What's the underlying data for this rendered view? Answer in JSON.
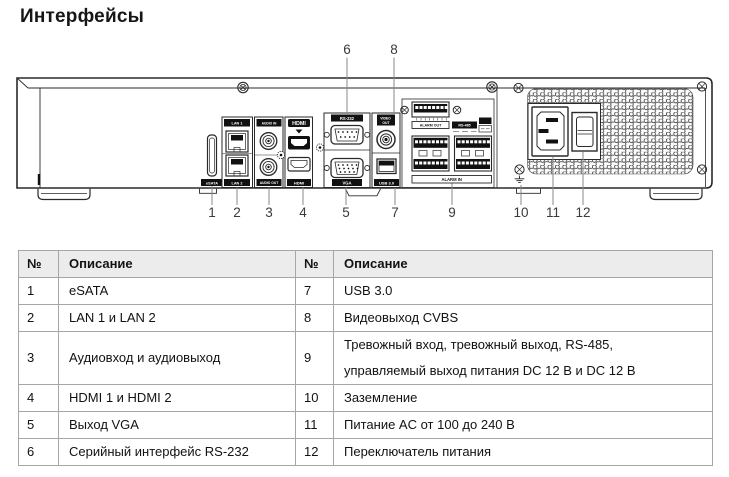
{
  "page": {
    "title": "Интерфейсы"
  },
  "diagram": {
    "labels": {
      "esata": "eSATA",
      "lan1": "LAN 1",
      "lan2": "LAN 2",
      "audio_in": "AUDIO IN",
      "audio_out": "AUDIO OUT",
      "hdmi_logo": "HDMI",
      "hdmi": "HDMI",
      "rs232": "RS-232",
      "vga": "VGA",
      "video_out_line1": "VIDEO",
      "video_out_line2": "OUT",
      "usb": "USB 3.0",
      "alarm_out": "ALARM OUT",
      "rs485": "RS-485",
      "alarm_in": "ALARM IN"
    },
    "callouts": {
      "top": [
        "6",
        "8"
      ],
      "bottom": [
        "1",
        "2",
        "3",
        "4",
        "5",
        "7",
        "9",
        "10",
        "11",
        "12"
      ]
    }
  },
  "table": {
    "headers": [
      "№",
      "Описание",
      "№",
      "Описание"
    ],
    "rows": [
      [
        "1",
        "eSATA",
        "7",
        "USB 3.0"
      ],
      [
        "2",
        "LAN 1 и LAN 2",
        "8",
        "Видеовыход CVBS"
      ],
      [
        "3",
        "Аудиовход и аудиовыход",
        "9",
        "Тревожный вход, тревожный выход, RS-485,\nуправляемый выход питания DC 12 В и DC 12 В"
      ],
      [
        "4",
        "HDMI 1 и HDMI 2",
        "10",
        "Заземление"
      ],
      [
        "5",
        "Выход VGA",
        "11",
        "Питание AC от 100 до 240 В"
      ],
      [
        "6",
        "Серийный интерфейс RS-232",
        "12",
        "Переключатель питания"
      ]
    ]
  }
}
